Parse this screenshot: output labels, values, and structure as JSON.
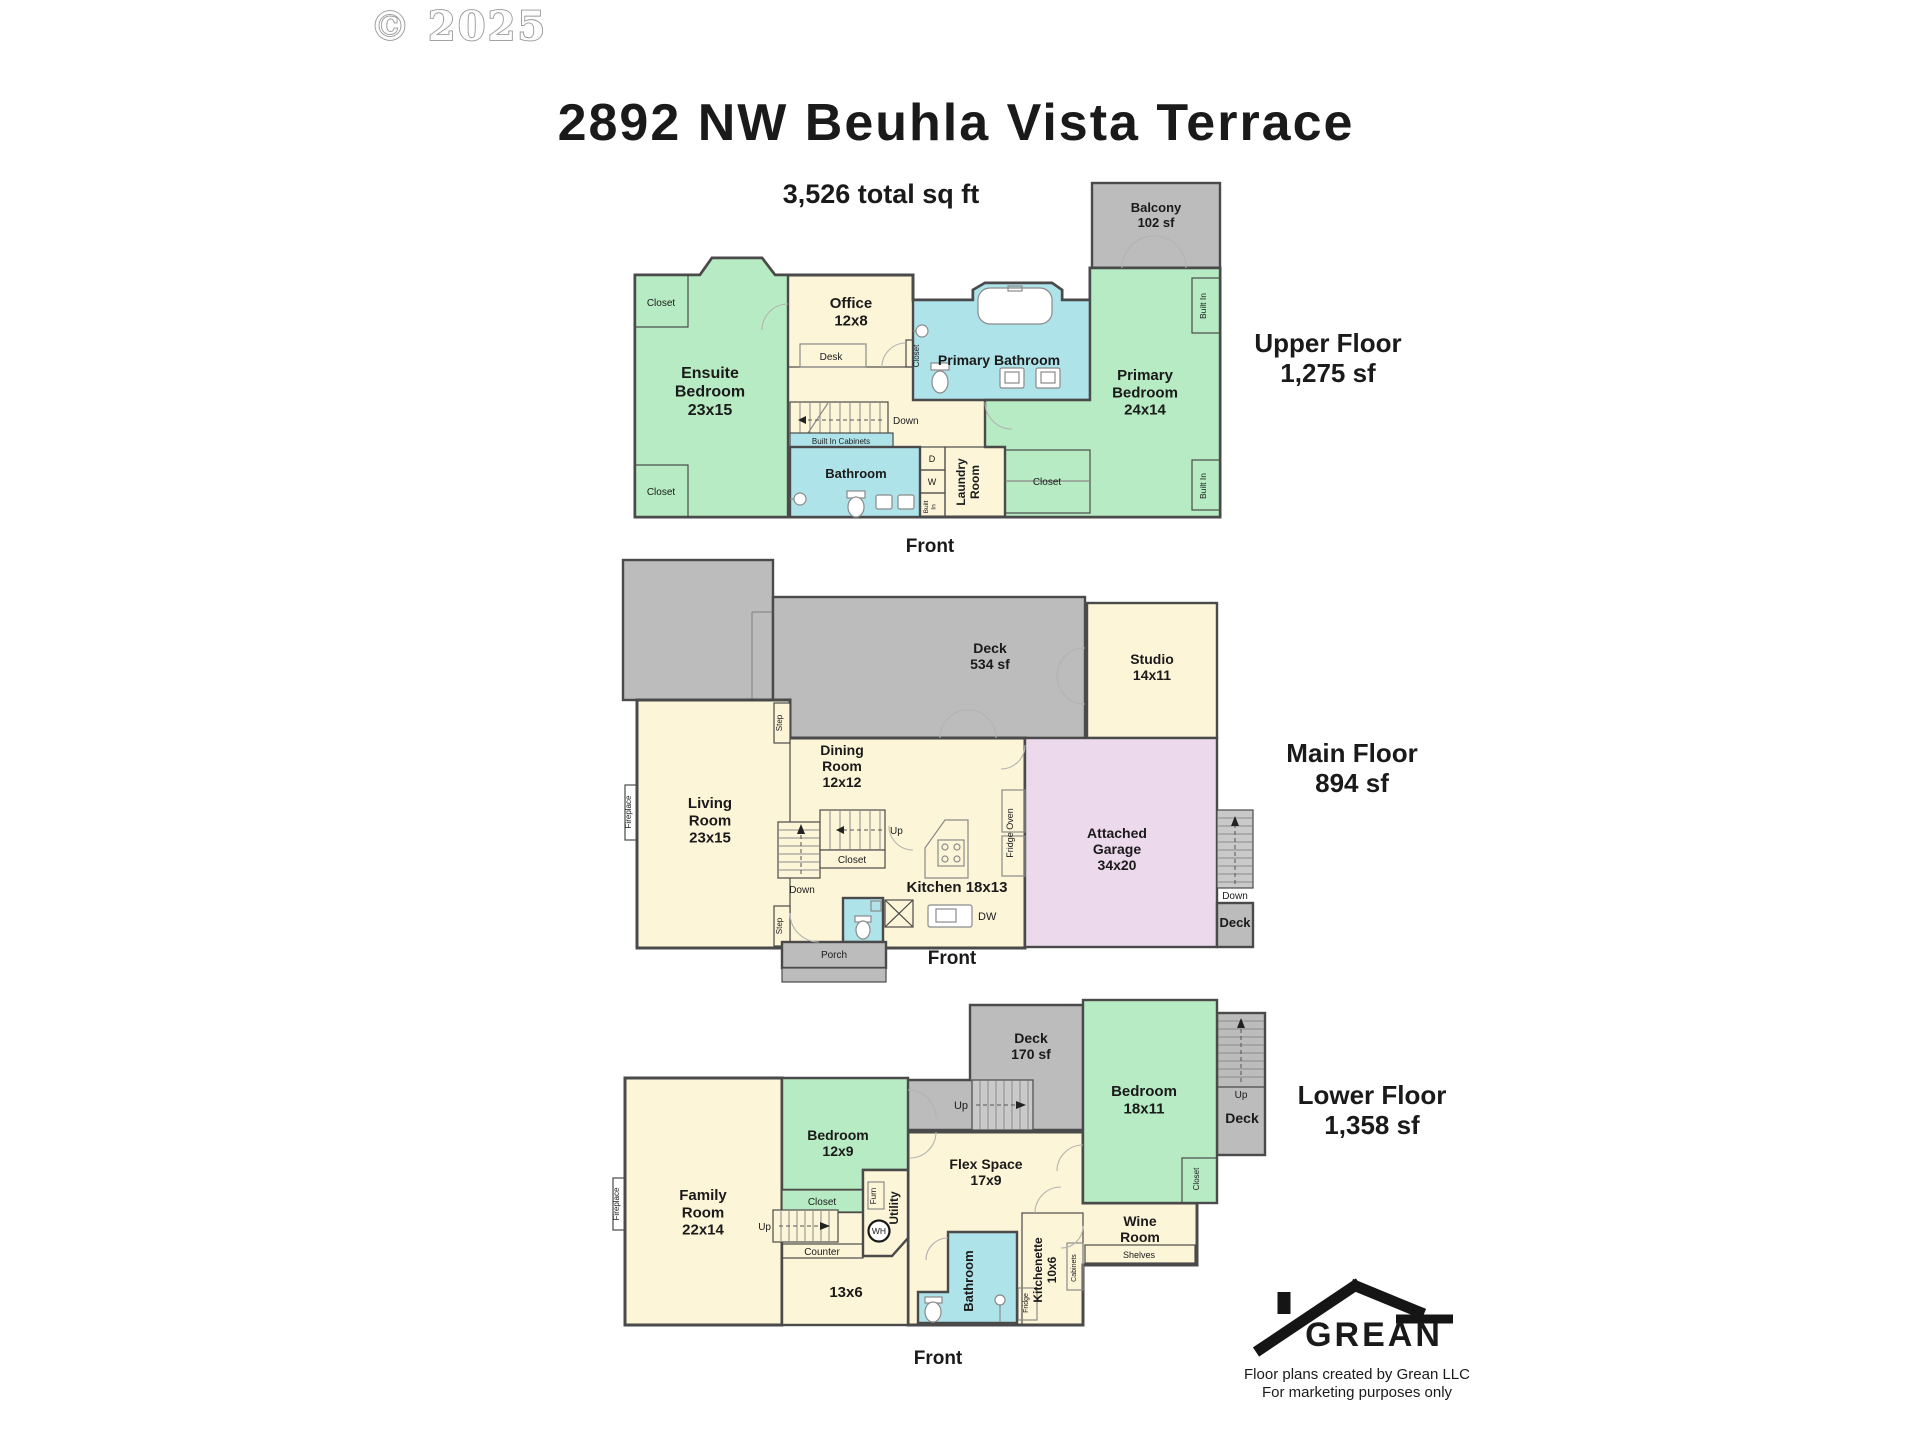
{
  "colors": {
    "room_green": "#b7ebc3",
    "room_cream": "#fdf5d8",
    "room_blue": "#aee3ea",
    "garage_pink": "#ecd9ec",
    "deck_gray": "#bcbcbc",
    "wall": "#4a4a4a",
    "brand_green": "#2d9e49",
    "roof_black": "#151515"
  },
  "header": {
    "copyright": "© 2025",
    "title": "2892 NW Beuhla Vista Terrace",
    "subtitle": "3,526 total sq ft"
  },
  "footer": {
    "brand": "GREAN",
    "caption_line1": "Floor plans created by Grean LLC",
    "caption_line2": "For marketing purposes only"
  },
  "floors": {
    "upper": {
      "title": "Upper Floor\n1,275 sf",
      "front": "Front",
      "labels": {
        "balcony": "Balcony\n102 sf",
        "ensuite_bedroom": "Ensuite\nBedroom\n23x15",
        "office": "Office\n12x8",
        "desk": "Desk",
        "primary_bathroom": "Primary Bathroom",
        "primary_bedroom": "Primary\nBedroom\n24x14",
        "bathroom": "Bathroom",
        "laundry_room": "Laundry\nRoom",
        "closet_top_left": "Closet",
        "closet_bottom_left": "Closet",
        "closet_hall": "Closet",
        "closet_primary": "Closet",
        "down": "Down",
        "built_in_cabinets": "Built In Cabinets",
        "dryer": "D",
        "washer": "W",
        "built_in_small": "Built\nIn",
        "built_in_top": "Built In",
        "built_in_bottom": "Built In"
      }
    },
    "main": {
      "title": "Main Floor\n894 sf",
      "front": "Front",
      "labels": {
        "deck": "Deck\n534 sf",
        "studio": "Studio\n14x11",
        "dining_room": "Dining\nRoom\n12x12",
        "living_room": "Living\nRoom\n23x15",
        "kitchen": "Kitchen 18x13",
        "garage": "Attached\nGarage\n34x20",
        "fireplace": "Fireplace",
        "step_top": "Step",
        "step_bottom": "Step",
        "up": "Up",
        "down": "Down",
        "closet": "Closet",
        "porch": "Porch",
        "dw": "DW",
        "fridge_oven": "Fridge Oven",
        "down_right": "Down",
        "deck_right": "Deck"
      }
    },
    "lower": {
      "title": "Lower Floor\n1,358 sf",
      "front": "Front",
      "labels": {
        "deck": "Deck\n170 sf",
        "bedroom_right": "Bedroom\n18x11",
        "bedroom_left": "Bedroom\n12x9",
        "flex_space": "Flex Space\n17x9",
        "family_room": "Family\nRoom\n22x14",
        "wine_room": "Wine\nRoom",
        "shelves": "Shelves",
        "kitchenette": "Kitchenette\n10x6",
        "bathroom": "Bathroom",
        "utility": "Utility",
        "furnace": "Furn",
        "water_heater": "WH",
        "counter": "Counter",
        "closet_left": "Closet",
        "closet_right": "Closet",
        "up_left": "Up",
        "up_mid": "Up",
        "up_right": "Up",
        "nook": "13x6",
        "fireplace": "Fireplace",
        "fridge": "Fridge",
        "cabinets": "Cabinets",
        "deck_right": "Deck"
      }
    }
  }
}
